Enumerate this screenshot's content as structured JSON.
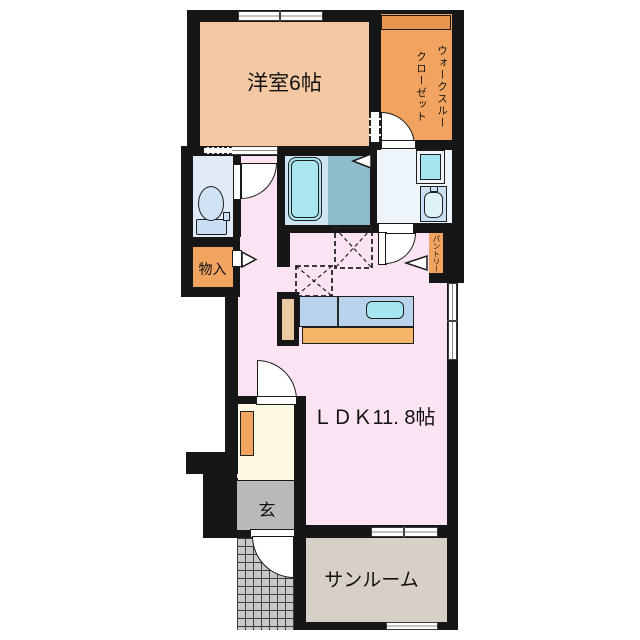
{
  "type": "apartment-floor-plan",
  "rooms": {
    "western_room": {
      "label": "洋室6帖"
    },
    "walk_through_closet": {
      "label": "ウォークスルー\nクローゼット"
    },
    "storage": {
      "label": "物入"
    },
    "pantry": {
      "label": "パントリー"
    },
    "ldk": {
      "label": "ＬＤＫ11. 8帖"
    },
    "entrance": {
      "label": "玄"
    },
    "sunroom": {
      "label": "サンルーム"
    }
  },
  "colors": {
    "wall": "#161616",
    "western_room_floor": "#f3c8a3",
    "closet_floor": "#f0a45f",
    "closet_shelf": "#e8944d",
    "ldk_floor": "#fbe3f3",
    "entrance_hall_floor": "#fdf8e2",
    "genkan_floor": "#b9b9b9",
    "sunroom_floor": "#d8d0c7",
    "porch_tile": "#c9c9c9",
    "toilet_room_floor": "#dfeaf6",
    "bathroom_floor_light": "#cde5f3",
    "bathroom_floor_dark": "#8fbccd",
    "bathtub": "#a9e7f0",
    "washroom_floor": "#edf5fb",
    "fixture_blue": "#cadff3",
    "counter_top": "#b9d3ed",
    "sink_cyan": "#a5e6f0",
    "counter_base": "#f4b569",
    "counter_side_panel": "#e9c9a1"
  }
}
